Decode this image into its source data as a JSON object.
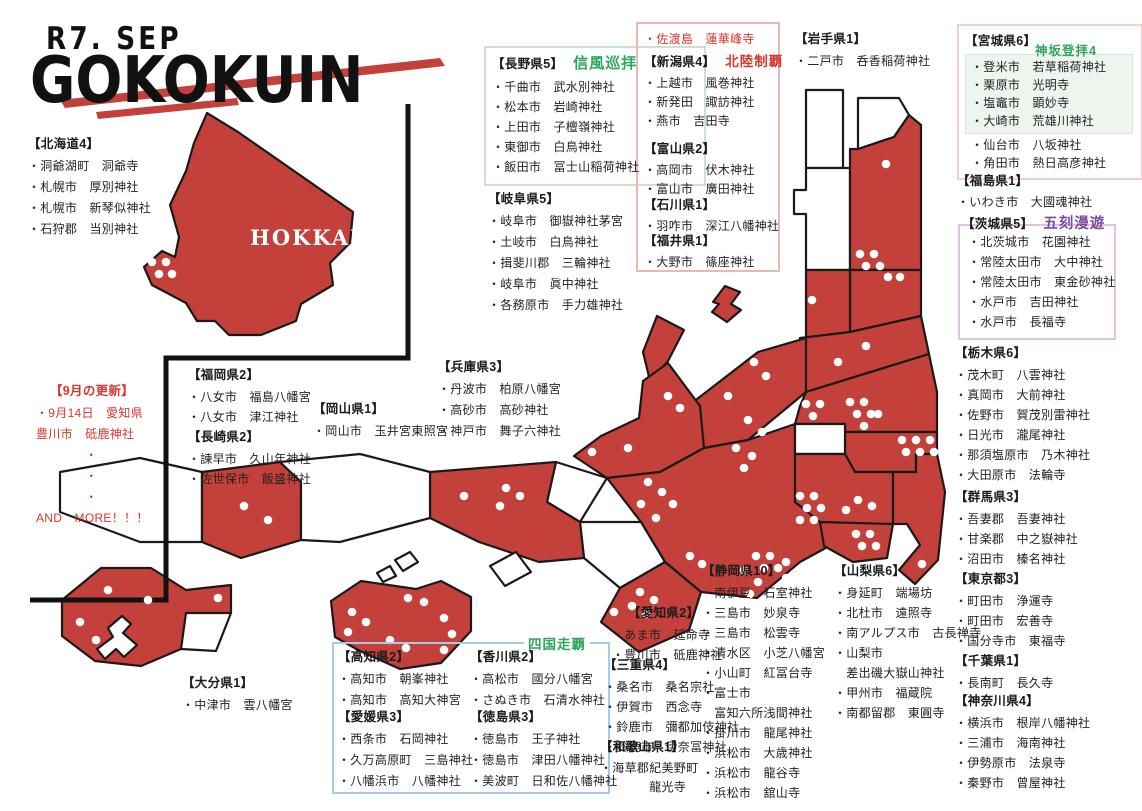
{
  "header": {
    "subtitle": "R7. SEP",
    "title": "GOKOKUIN"
  },
  "colors": {
    "map_red": "#c4403a",
    "outline": "#1a1a1a",
    "accent_red": "#d8372f",
    "badge_green": "#2ea65a",
    "badge_purple": "#7a4ba0",
    "box_pink": "#e9b8b2",
    "box_green": "#c9e3cf",
    "box_blue": "#a9c9e5",
    "box_purple": "#dfc3e3",
    "inner_green_bg": "#edf5ee",
    "miyagi_box": "#f0d0cc"
  },
  "shikoku_badge": "四国走覇",
  "lists": [
    {
      "header": "【北海道4】",
      "items": [
        "・洞爺湖町　洞爺寺",
        "・札幌市　厚別神社",
        "・札幌市　新琴似神社",
        "・石狩郡　当別神社"
      ]
    },
    {
      "header": "【長野県5】",
      "badge": "信風巡拝",
      "items": [
        "・千曲市　武水別神社",
        "・松本市　岩崎神社",
        "・上田市　子檀嶺神社",
        "・東御市　白鳥神社",
        "・飯田市　冨士山稲荷神社"
      ]
    },
    {
      "header": "【岐阜県5】",
      "items": [
        "・岐阜市　御嶽神社茅宮",
        "・土岐市　白鳥神社",
        "・揖斐川郡　三輪神社",
        "・岐阜市　眞中神社",
        "・各務原市　手力雄神社"
      ]
    },
    {
      "items": [
        "・佐渡島　蓮華峰寺"
      ]
    },
    {
      "header": "【新潟県4】",
      "badge": "北陸制覇",
      "items": [
        "・上越市　風巻神社",
        "・新発田　諏訪神社",
        "・燕市　吉田寺"
      ]
    },
    {
      "header": "【富山県2】",
      "items": [
        "・高岡市　伏木神社",
        "・富山市　廣田神社"
      ]
    },
    {
      "header": "【石川県1】",
      "items": [
        "・羽咋市　深江八幡神社"
      ]
    },
    {
      "header": "【福井県1】",
      "items": [
        "・大野市　篠座神社"
      ]
    },
    {
      "header": "【岩手県1】",
      "items": [
        "・二戸市　呑香稲荷神社"
      ]
    },
    {
      "header": "【宮城県6】",
      "badge": "神坂登拝4",
      "items_a": [
        "・登米市　若草稲荷神社",
        "・栗原市　光明寺",
        "・塩竈市　顕妙寺",
        "・大崎市　荒雄川神社"
      ],
      "items_b": [
        "・仙台市　八坂神社",
        "・角田市　熱日高彦神社"
      ]
    },
    {
      "header": "【福島県1】",
      "items": [
        "・いわき市　大國魂神社"
      ]
    },
    {
      "header": "【茨城県5】",
      "badge": "五刻漫遊",
      "items": [
        "・北茨城市　花園神社",
        "・常陸太田市　大中神社",
        "・常陸太田市　東金砂神社",
        "・水戸市　吉田神社",
        "・水戸市　長福寺"
      ]
    },
    {
      "header": "【栃木県6】",
      "items": [
        "・茂木町　八雲神社",
        "・真岡市　大前神社",
        "・佐野市　賀茂別雷神社",
        "・日光市　瀧尾神社",
        "・那須塩原市　乃木神社",
        "・大田原市　法輪寺"
      ]
    },
    {
      "header": "【群馬県3】",
      "items": [
        "・吾妻郡　吾妻神社",
        "・甘楽郡　中之嶽神社",
        "・沼田市　榛名神社"
      ]
    },
    {
      "header": "【東京都3】",
      "items": [
        "・町田市　浄運寺",
        "・町田市　宏善寺",
        "・国分寺市　東福寺"
      ]
    },
    {
      "header": "【千葉県1】",
      "items": [
        "・長南町　長久寺"
      ]
    },
    {
      "header": "【神奈川県4】",
      "items": [
        "・横浜市　根岸八幡神社",
        "・三浦市　海南神社",
        "・伊勢原市　法泉寺",
        "・秦野市　曾屋神社"
      ]
    },
    {
      "header": "【9月の更新】",
      "items": [
        "・9月14日　愛知県",
        "豊川市　砥鹿神社",
        "　　　　・",
        "　　　　・",
        "　　　　・",
        "AND　MORE！！！"
      ]
    },
    {
      "header": "【福岡県2】",
      "items": [
        "・八女市　福島八幡宮",
        "・八女市　津江神社"
      ]
    },
    {
      "header": "【長崎県2】",
      "items": [
        "・諫早市　久山年神社",
        "・佐世保市　飯盛神社"
      ]
    },
    {
      "header": "【岡山県1】",
      "items": [
        "・岡山市　玉井宮東照宮"
      ]
    },
    {
      "header": "【兵庫県3】",
      "items": [
        "・丹波市　柏原八幡宮",
        "・高砂市　高砂神社",
        "・神戸市　舞子六神社"
      ]
    },
    {
      "header": "【大分県1】",
      "items": [
        "・中津市　雲八幡宮"
      ]
    },
    {
      "header": "【高知県2】",
      "items": [
        "・高知市　朝峯神社",
        "・高知市　高知大神宮"
      ]
    },
    {
      "header": "【愛媛県3】",
      "items": [
        "・西条市　石岡神社",
        "・久万高原町　三島神社",
        "・八幡浜市　八幡神社"
      ]
    },
    {
      "header": "【香川県2】",
      "items": [
        "・高松市　國分八幡宮",
        "・さぬき市　石清水神社"
      ]
    },
    {
      "header": "【徳島県3】",
      "items": [
        "・徳島市　王子神社",
        "・徳島市　津田八幡神社",
        "・美波町　日和佐八幡神社"
      ]
    },
    {
      "header": "【愛知県2】",
      "items": [
        "・あま市　延命寺",
        "・豊川市　砥鹿神社"
      ]
    },
    {
      "header": "【三重県4】",
      "items": [
        "・桑名市　桑名宗社",
        "・伊賀市　西念寺",
        "・鈴鹿市　彌都加伎神社",
        "・鈴鹿市　伊奈冨神社"
      ]
    },
    {
      "header": "【和歌山県1】",
      "items": [
        "・海草郡紀美野町",
        "　　　　龍光寺"
      ]
    },
    {
      "header": "【静岡県10】",
      "items": [
        "・南伊豆　石室神社",
        "・三島市　妙泉寺",
        "・三島市　松雲寺",
        "・清水区　小芝八幡宮",
        "・小山町　紅冨台寺",
        "・富士市",
        "　富知六所浅間神社",
        "・掛川市　龍尾神社",
        "・浜松市　大歳神社",
        "・浜松市　龍谷寺",
        "・浜松市　舘山寺"
      ]
    },
    {
      "header": "【山梨県6】",
      "items": [
        "・身延町　端場坊",
        "・北杜市　遠照寺",
        "・南アルプス市　古長禅寺",
        "・山梨市",
        "　差出磯大嶽山神社",
        "・甲州市　福蔵院",
        "・南都留郡　東圓寺"
      ]
    }
  ],
  "map": {
    "label": "HOKKAIDO",
    "frame": "408,104 408,358 166,358 166,600 30,600",
    "decor": [
      {
        "p": "60,100 440,58 445,66 65,108"
      },
      {
        "p": "96,112 237,98 239,105 98,119"
      }
    ],
    "shapes": [
      {
        "f": "r",
        "p": "207,113 238,132 353,212 350,243 330,263 333,285 301,304 296,321 261,335 229,335 215,321 197,321 186,303 152,285 144,267 162,251 175,257 179,237 170,205 186,171 194,143"
      },
      {
        "f": "w",
        "p": "806,90 843,90 843,168 806,168"
      },
      {
        "f": "w",
        "p": "858,98 899,98 909,115 894,137 858,149"
      },
      {
        "f": "w",
        "p": "806,168 850,168 850,270 806,270 806,214 794,214 794,190 806,190"
      },
      {
        "f": "r",
        "p": "850,149 858,149 894,137 909,115 921,125 921,270 850,270"
      },
      {
        "f": "r",
        "p": "850,270 921,270 921,316 850,332"
      },
      {
        "f": "r",
        "p": "806,270 850,270 850,332 806,338"
      },
      {
        "f": "r",
        "p": "800,338 850,332 921,316 929,354 806,392"
      },
      {
        "f": "r",
        "p": "688,406 758,352 806,338 806,392 748,440 704,448"
      },
      {
        "f": "r",
        "p": "713,302 725,286 740,292 731,304 741,310 727,322 712,312 719,304"
      },
      {
        "f": "r",
        "p": "657,316 684,330 668,361 650,381 643,352"
      },
      {
        "f": "r",
        "p": "643,381 668,363 700,406 704,448 660,472 607,478 574,456 601,436 639,418"
      },
      {
        "f": "r",
        "p": "660,472 704,448 748,440 795,424 795,454 845,454 855,472 855,532 800,562 757,598 701,592 665,562 641,522 607,478"
      },
      {
        "f": "r",
        "p": "806,392 929,354 937,392 937,432 845,432 845,424 795,424 800,406"
      },
      {
        "f": "r",
        "p": "845,432 937,432 937,454 916,454 916,472 855,472 845,454"
      },
      {
        "f": "w",
        "p": "795,424 845,424 845,454 795,454"
      },
      {
        "f": "r",
        "p": "795,454 845,454 855,472 893,472 893,524 853,532 820,522 795,502"
      },
      {
        "f": "r",
        "p": "820,522 893,524 887,558 853,562 824,546"
      },
      {
        "f": "r",
        "p": "893,472 916,472 916,454 937,454 945,492 938,560 915,584 899,570 920,545 907,524 893,524"
      },
      {
        "f": "w",
        "p": "556,462 607,478 580,522 547,502"
      },
      {
        "f": "w",
        "p": "580,522 641,522 665,562 620,588 584,558"
      },
      {
        "f": "r",
        "p": "620,588 665,562 701,592 689,630 639,652 601,622"
      },
      {
        "f": "r",
        "p": "430,472 556,462 547,502 580,522 584,558 539,562 479,542 430,518"
      },
      {
        "f": "w",
        "p": "60,472 140,458 202,472 202,542 140,542 60,512"
      },
      {
        "f": "r",
        "p": "202,472 280,462 301,482 301,540 241,558 202,542"
      },
      {
        "f": "w",
        "p": "280,462 360,454 430,472 430,518 340,542 301,540 301,482"
      },
      {
        "f": "w",
        "p": "490,566 516,552 531,572 505,586"
      },
      {
        "f": "w",
        "p": "395,560 410,552 418,562 403,571"
      },
      {
        "f": "w",
        "p": "377,573 390,566 396,576 383,582"
      },
      {
        "f": "r",
        "p": "331,601 361,581 416,589 441,581 471,597 471,631 441,663 400,669 360,651 335,637"
      },
      {
        "f": "r",
        "p": "62,600 101,568 151,568 186,590 231,585 231,613 196,619 181,649 141,666 95,661 62,636"
      },
      {
        "f": "w",
        "p": "186,613 231,613 216,651 181,649"
      },
      {
        "f": "w",
        "p": "108,628 122,616 131,624 123,633 137,645 124,657 116,649 105,659 97,649 113,637"
      }
    ],
    "dots": [
      [
        152,
        262
      ],
      [
        166,
        262
      ],
      [
        159,
        274
      ],
      [
        172,
        274
      ],
      [
        886,
        164
      ],
      [
        860,
        254
      ],
      [
        874,
        254
      ],
      [
        866,
        266
      ],
      [
        880,
        266
      ],
      [
        888,
        277
      ],
      [
        900,
        277
      ],
      [
        812,
        300
      ],
      [
        866,
        346
      ],
      [
        838,
        362
      ],
      [
        754,
        362
      ],
      [
        766,
        376
      ],
      [
        728,
        396
      ],
      [
        668,
        396
      ],
      [
        680,
        408
      ],
      [
        628,
        448
      ],
      [
        592,
        452
      ],
      [
        748,
        420
      ],
      [
        762,
        432
      ],
      [
        736,
        448
      ],
      [
        752,
        456
      ],
      [
        744,
        468
      ],
      [
        648,
        482
      ],
      [
        662,
        492
      ],
      [
        641,
        504
      ],
      [
        673,
        504
      ],
      [
        656,
        518
      ],
      [
        806,
        404
      ],
      [
        820,
        404
      ],
      [
        813,
        416
      ],
      [
        850,
        402
      ],
      [
        864,
        402
      ],
      [
        857,
        414
      ],
      [
        871,
        414
      ],
      [
        864,
        426
      ],
      [
        878,
        414
      ],
      [
        902,
        440
      ],
      [
        916,
        440
      ],
      [
        930,
        440
      ],
      [
        906,
        452
      ],
      [
        920,
        452
      ],
      [
        934,
        452
      ],
      [
        858,
        500
      ],
      [
        872,
        506
      ],
      [
        846,
        510
      ],
      [
        856,
        534
      ],
      [
        870,
        534
      ],
      [
        862,
        546
      ],
      [
        876,
        546
      ],
      [
        922,
        564
      ],
      [
        800,
        496
      ],
      [
        814,
        496
      ],
      [
        807,
        508
      ],
      [
        821,
        508
      ],
      [
        800,
        520
      ],
      [
        814,
        520
      ],
      [
        756,
        556
      ],
      [
        770,
        556
      ],
      [
        764,
        568
      ],
      [
        778,
        568
      ],
      [
        744,
        570
      ],
      [
        758,
        582
      ],
      [
        772,
        592
      ],
      [
        750,
        594
      ],
      [
        786,
        578
      ],
      [
        786,
        562
      ],
      [
        690,
        556
      ],
      [
        702,
        564
      ],
      [
        640,
        592
      ],
      [
        654,
        600
      ],
      [
        632,
        606
      ],
      [
        646,
        614
      ],
      [
        614,
        612
      ],
      [
        506,
        488
      ],
      [
        520,
        496
      ],
      [
        500,
        506
      ],
      [
        464,
        496
      ],
      [
        244,
        506
      ],
      [
        268,
        520
      ],
      [
        408,
        598
      ],
      [
        424,
        602
      ],
      [
        444,
        618
      ],
      [
        452,
        634
      ],
      [
        444,
        650
      ],
      [
        352,
        612
      ],
      [
        366,
        622
      ],
      [
        348,
        632
      ],
      [
        390,
        640
      ],
      [
        406,
        648
      ],
      [
        108,
        590
      ],
      [
        80,
        622
      ],
      [
        96,
        640
      ],
      [
        148,
        600
      ],
      [
        218,
        598
      ]
    ]
  }
}
